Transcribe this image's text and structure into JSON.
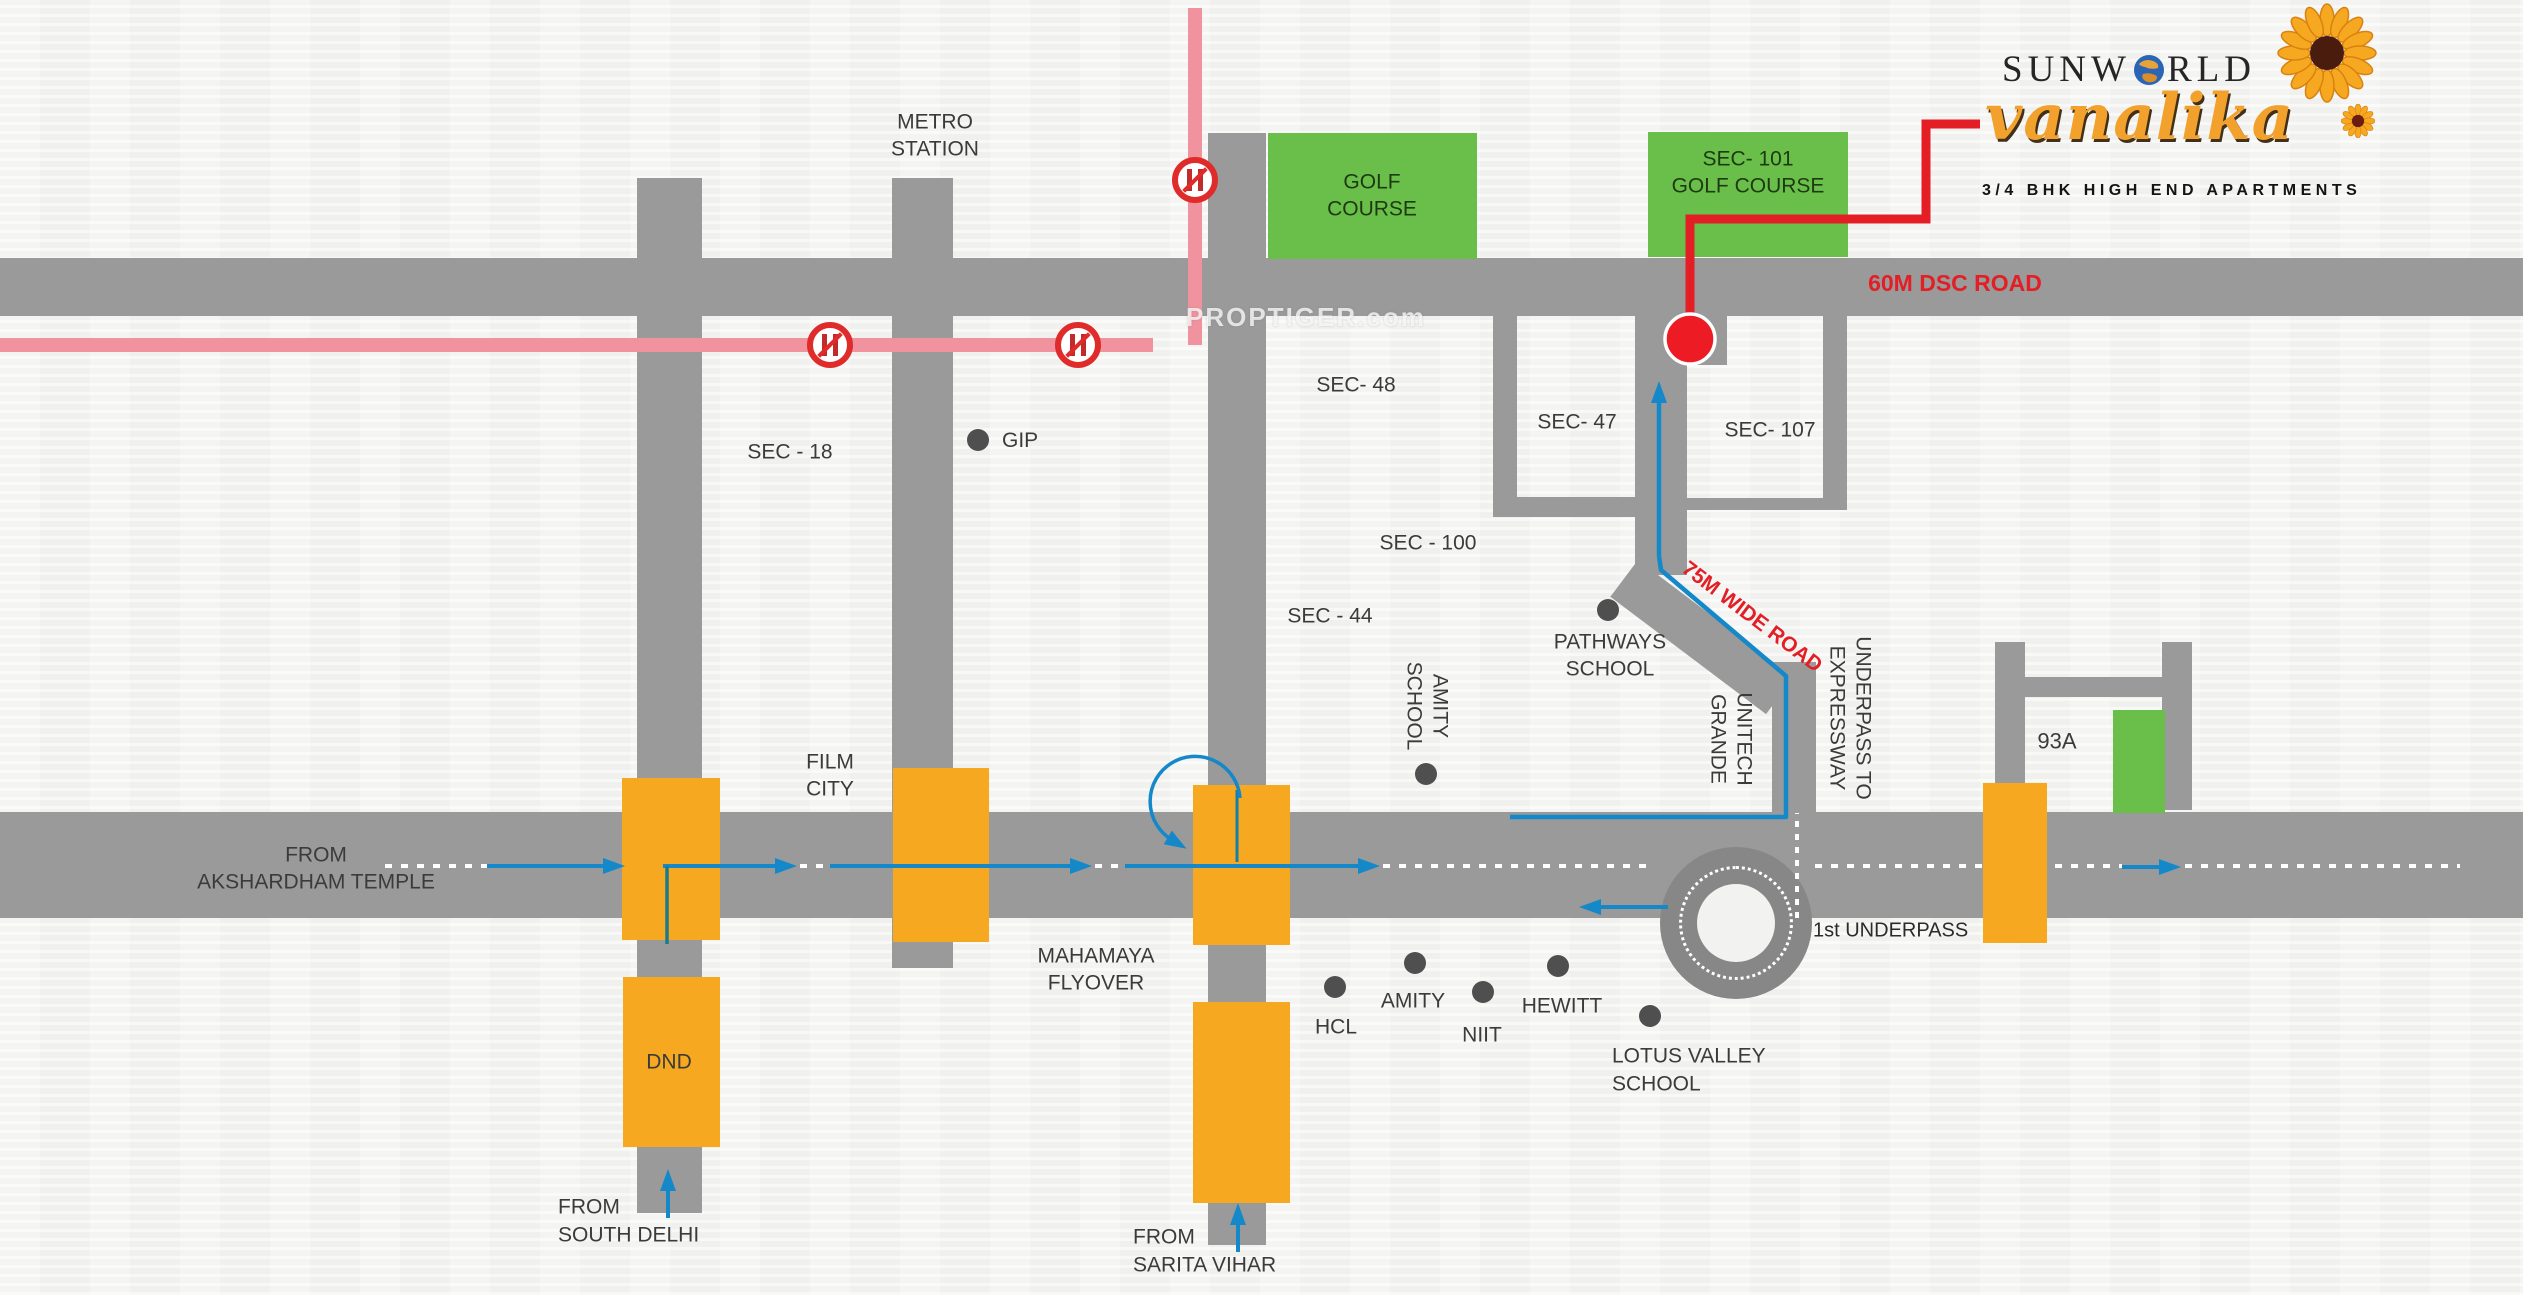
{
  "logo": {
    "brand_pre": "SUNW",
    "brand_post": "RLD",
    "name": "vanalika",
    "tagline": "3/4 BHK HIGH END APARTMENTS"
  },
  "watermark": "PROPTIGER.com",
  "road_labels": {
    "dsc": "60M DSC ROAD",
    "wide75": "75M WIDE ROAD",
    "first_underpass": "1st UNDERPASS"
  },
  "labels": {
    "metro": "METRO\nSTATION",
    "golf": "GOLF\nCOURSE",
    "sec101": "SEC- 101\nGOLF COURSE",
    "sec18": "SEC - 18",
    "gip": "GIP",
    "sec48": "SEC- 48",
    "sec47": "SEC- 47",
    "sec107": "SEC- 107",
    "sec100": "SEC - 100",
    "sec44": "SEC - 44",
    "pathways": "PATHWAYS\nSCHOOL",
    "amity_school": "AMITY\nSCHOOL",
    "unitech": "UNITECH\nGRANDE",
    "underpass_exp": "UNDERPASS TO\nEXPRESSWAY",
    "a93": "93A",
    "akshardham": "FROM\nAKSHARDHAM TEMPLE",
    "film_city": "FILM\nCITY",
    "mahamaya": "MAHAMAYA\nFLYOVER",
    "dnd": "DND",
    "south_delhi": "FROM\nSOUTH DELHI",
    "sarita": "FROM\nSARITA VIHAR",
    "hcl": "HCL",
    "amity": "AMITY",
    "niit": "NIIT",
    "hewitt": "HEWITT",
    "lotus": "LOTUS VALLEY\nSCHOOL"
  },
  "colors": {
    "road": "#9a9a9a",
    "intersection_orange": "#F6A821",
    "green_area": "#6ABF4B",
    "pink_road": "#F0939E",
    "accent_red": "#E31E24",
    "route_blue": "#1488C8",
    "landmark_dot": "#4f4f4f",
    "label_text": "#3b3b3b"
  }
}
